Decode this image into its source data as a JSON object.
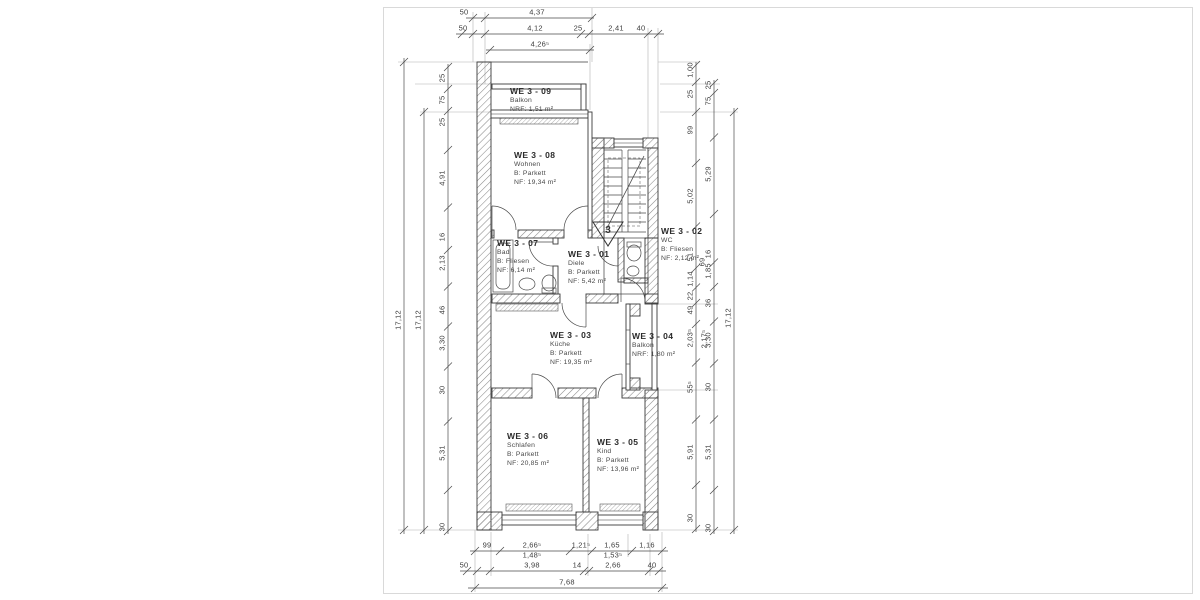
{
  "drawing": {
    "type": "floor-plan",
    "units": "m",
    "stair_marker": "3"
  },
  "rooms": [
    {
      "id": "WE 3 - 09",
      "lines": [
        "Balkon",
        "NRF: 1,51 m²"
      ],
      "x": 510,
      "y": 86
    },
    {
      "id": "WE 3 - 08",
      "lines": [
        "Wohnen",
        "B: Parkett",
        "NF: 19,34 m²"
      ],
      "x": 514,
      "y": 150
    },
    {
      "id": "WE 3 - 07",
      "lines": [
        "Bad",
        "B: Fliesen",
        "NF: 6,14 m²"
      ],
      "x": 497,
      "y": 238
    },
    {
      "id": "WE 3 - 01",
      "lines": [
        "Diele",
        "B: Parkett",
        "NF: 5,42 m²"
      ],
      "x": 568,
      "y": 249
    },
    {
      "id": "WE 3 - 02",
      "lines": [
        "WC",
        "B: Fliesen",
        "NF: 2,12 m²"
      ],
      "x": 661,
      "y": 226
    },
    {
      "id": "WE 3 - 03",
      "lines": [
        "Küche",
        "B: Parkett",
        "NF: 19,35 m²"
      ],
      "x": 550,
      "y": 330
    },
    {
      "id": "WE 3 - 04",
      "lines": [
        "Balkon",
        "NRF: 1,80 m²"
      ],
      "x": 632,
      "y": 331
    },
    {
      "id": "WE 3 - 06",
      "lines": [
        "Schlafen",
        "B: Parkett",
        "NF: 20,85 m²"
      ],
      "x": 507,
      "y": 431
    },
    {
      "id": "WE 3 - 05",
      "lines": [
        "Kind",
        "B: Parkett",
        "NF: 13,96 m²"
      ],
      "x": 597,
      "y": 437
    }
  ],
  "dim_chains": [
    {
      "dir": "h",
      "pos": 18,
      "from": 466,
      "to": 594,
      "ticks": [
        473,
        485,
        592
      ],
      "labels": [
        {
          "t": "50",
          "c": 464
        },
        {
          "t": "4,37",
          "c": 537
        }
      ]
    },
    {
      "dir": "h",
      "pos": 34,
      "from": 456,
      "to": 664,
      "ticks": [
        462,
        473,
        485,
        581,
        589,
        648,
        658
      ],
      "labels": [
        {
          "t": "50",
          "c": 463
        },
        {
          "t": "4,12",
          "c": 535
        },
        {
          "t": "25",
          "c": 578
        },
        {
          "t": "2,41",
          "c": 616
        },
        {
          "t": "40",
          "c": 641
        }
      ]
    },
    {
      "dir": "h",
      "pos": 50,
      "from": 486,
      "to": 594,
      "ticks": [
        490,
        590
      ],
      "labels": [
        {
          "t": "4,26⁵",
          "c": 540
        }
      ]
    },
    {
      "dir": "h",
      "pos": 551,
      "from": 470,
      "to": 668,
      "ticks": [
        475,
        500,
        570,
        592,
        632,
        662
      ],
      "labels": [
        {
          "t": "99",
          "c": 487
        },
        {
          "t": "2,66⁵",
          "c": 532
        },
        {
          "t": "1,21⁵",
          "c": 581
        },
        {
          "t": "1,65",
          "c": 612
        },
        {
          "t": "1,16",
          "c": 647
        }
      ]
    },
    {
      "dir": "h",
      "pos": 561,
      "from": 0,
      "to": 0,
      "noline": true,
      "ticks": [],
      "labels": [
        {
          "t": "1,48⁵",
          "c": 532
        },
        {
          "t": "1,53⁵",
          "c": 613
        }
      ]
    },
    {
      "dir": "h",
      "pos": 571,
      "from": 460,
      "to": 666,
      "ticks": [
        467,
        477,
        490,
        584,
        589,
        649,
        659
      ],
      "labels": [
        {
          "t": "50",
          "c": 464
        },
        {
          "t": "3,98",
          "c": 532
        },
        {
          "t": "14",
          "c": 577
        },
        {
          "t": "2,66",
          "c": 613
        },
        {
          "t": "40",
          "c": 652
        }
      ]
    },
    {
      "dir": "h",
      "pos": 588,
      "from": 468,
      "to": 668,
      "ticks": [
        475,
        662
      ],
      "labels": [
        {
          "t": "7,68",
          "c": 567
        }
      ]
    },
    {
      "dir": "v",
      "pos": 448,
      "from": 64,
      "to": 534,
      "labels": [
        {
          "t": "25",
          "c": 78
        },
        {
          "t": "75",
          "c": 100
        },
        {
          "t": "25",
          "c": 122
        },
        {
          "t": "4,91",
          "c": 178
        },
        {
          "t": "16",
          "c": 237
        },
        {
          "t": "2,13",
          "c": 263
        },
        {
          "t": "46",
          "c": 310
        },
        {
          "t": "3,30",
          "c": 343
        },
        {
          "t": "30",
          "c": 390
        },
        {
          "t": "5,31",
          "c": 453
        },
        {
          "t": "30",
          "c": 527
        }
      ]
    },
    {
      "dir": "v",
      "pos": 424,
      "from": 108,
      "to": 534,
      "ticks": [
        112,
        530
      ],
      "labels": [
        {
          "t": "17,12",
          "c": 320
        }
      ]
    },
    {
      "dir": "v",
      "pos": 404,
      "from": 58,
      "to": 534,
      "ticks": [
        62,
        530
      ],
      "labels": [
        {
          "t": "17,12",
          "c": 320
        }
      ]
    },
    {
      "dir": "v",
      "pos": 696,
      "from": 62,
      "to": 532,
      "labels": [
        {
          "t": "1,00",
          "c": 70
        },
        {
          "t": "25",
          "c": 94
        },
        {
          "t": "99",
          "c": 130
        },
        {
          "t": "5,02",
          "c": 196
        },
        {
          "t": "51",
          "c": 257
        },
        {
          "t": "1,14",
          "c": 279
        },
        {
          "t": "22",
          "c": 296
        },
        {
          "t": "49",
          "c": 310
        },
        {
          "t": "2,03⁵",
          "c": 338
        },
        {
          "t": "55⁵",
          "c": 387
        },
        {
          "t": "5,91",
          "c": 452
        },
        {
          "t": "30",
          "c": 518
        }
      ]
    },
    {
      "dir": "v",
      "pos": 714,
      "from": 80,
      "to": 534,
      "labels": [
        {
          "t": "25",
          "c": 85
        },
        {
          "t": "75",
          "c": 101
        },
        {
          "t": "5,29",
          "c": 174
        },
        {
          "t": "16",
          "c": 254
        },
        {
          "t": "1,85",
          "c": 271
        },
        {
          "t": "36",
          "c": 303
        },
        {
          "t": "3,30",
          "c": 340
        },
        {
          "t": "30",
          "c": 387
        },
        {
          "t": "5,31",
          "c": 452
        },
        {
          "t": "30",
          "c": 528
        }
      ]
    },
    {
      "dir": "v",
      "pos": 734,
      "from": 108,
      "to": 534,
      "ticks": [
        112,
        530
      ],
      "labels": [
        {
          "t": "17,12",
          "c": 318
        }
      ]
    }
  ],
  "extra_labels": [
    {
      "t": "2,17⁵",
      "x": 704,
      "y": 339,
      "rot": true
    },
    {
      "t": "69",
      "x": 702,
      "y": 262,
      "rot": true
    }
  ]
}
